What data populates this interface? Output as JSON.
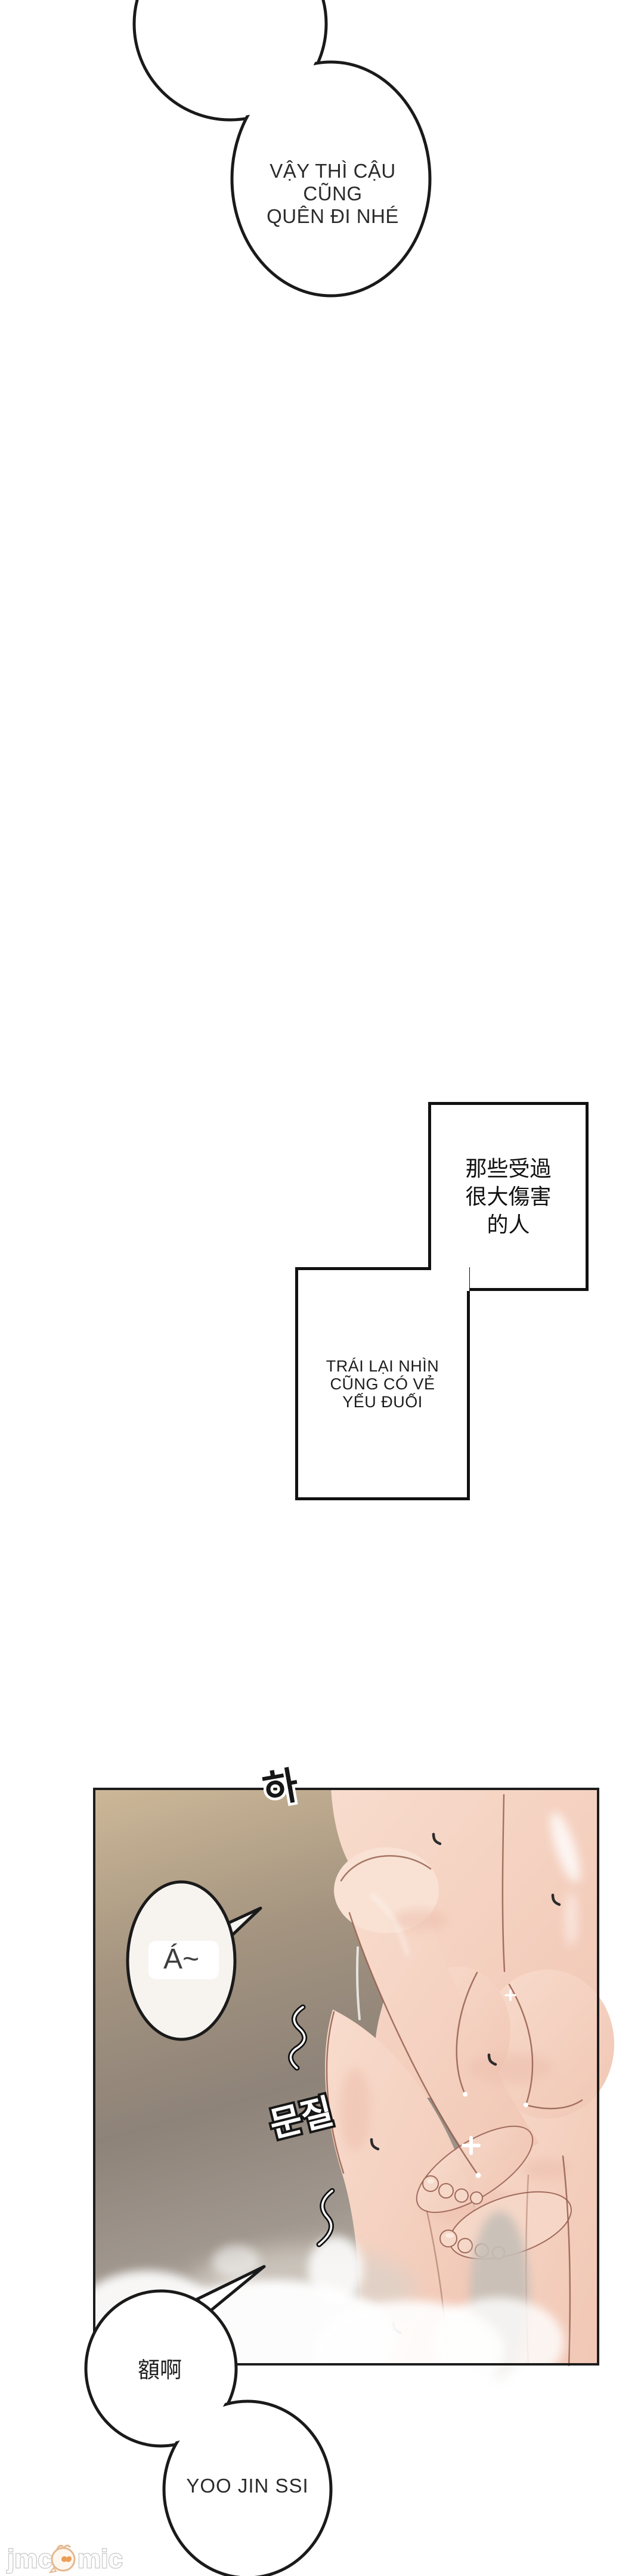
{
  "page": {
    "background": "#ffffff"
  },
  "colors": {
    "ink_outline": "#1a1a1a",
    "panel_bg_tan": "#cdb898",
    "panel_bg_gray": "#8e8379",
    "skin": "#f5d3c3",
    "skin_outline": "#96604f",
    "watermark_gray": "#cccccc",
    "watermark_accent": "#eb9e55"
  },
  "speech": {
    "top_bubble": {
      "lines": [
        "VẬY THÌ CẬU CŨNG",
        "QUÊN ĐI NHÉ"
      ]
    },
    "cn_box": {
      "lines": [
        "那些受過",
        "很大傷害",
        "的人"
      ]
    },
    "vn_box": {
      "lines": [
        "TRÁI LẠI NHÌN",
        "CŨNG CÓ VẺ",
        "YẾU ĐUỐI"
      ]
    },
    "scream_bubble": {
      "text": "Á~"
    },
    "moan_bubble": {
      "text": "額啊"
    },
    "name_bubble": {
      "text": "YOO JIN SSI"
    }
  },
  "sfx": {
    "breath": "하",
    "rub": "문질"
  },
  "watermark": {
    "prefix": "jmc",
    "suffix": "mic",
    "mascot_icon": "bird-mascot",
    "heart_icon": "heart"
  }
}
